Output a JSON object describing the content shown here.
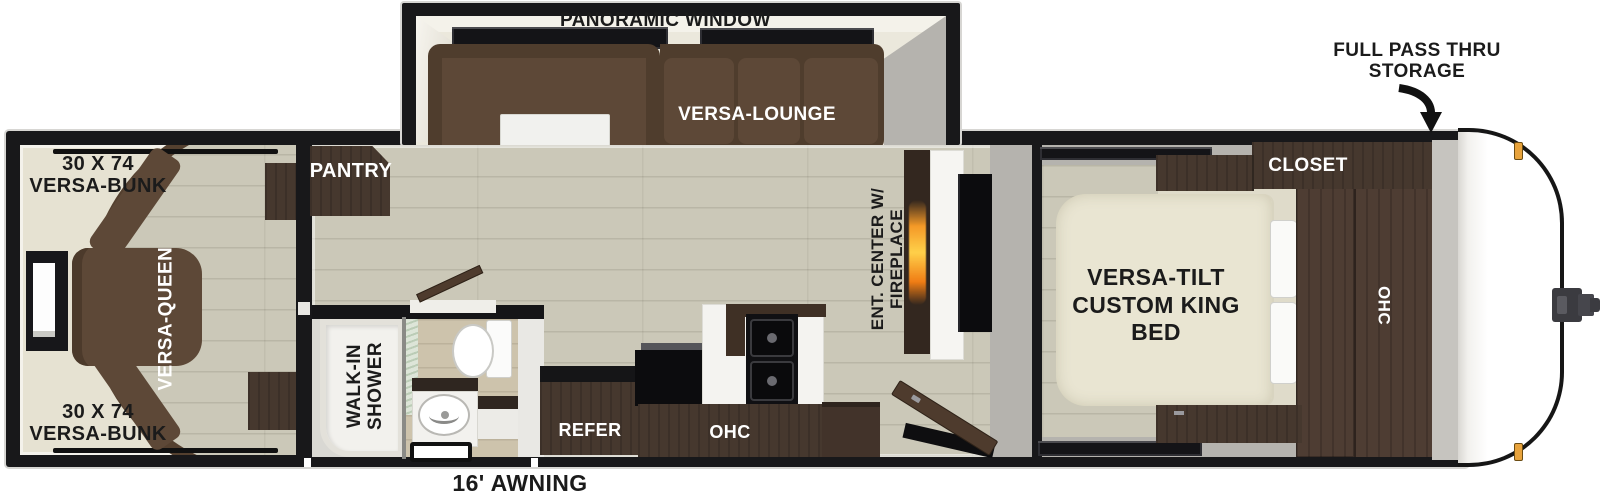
{
  "title": "Travel trailer floor plan",
  "labels": {
    "panoramic_window": "PANORAMIC WINDOW",
    "full_pass_thru_storage": "FULL PASS THRU STORAGE",
    "bunk_top": "30 X 74 VERSA-BUNK",
    "bunk_bottom": "30 X 74 VERSA-BUNK",
    "versa_queen": "VERSA-QUEEN",
    "pantry": "PANTRY",
    "versa_lounge": "VERSA-LOUNGE",
    "ent_center": "ENT. CENTER W/ FIREPLACE",
    "walk_in_shower": "WALK-IN SHOWER",
    "refer": "REFER",
    "kitchen_ohc": "OHC",
    "closet": "CLOSET",
    "king_bed": "VERSA-TILT CUSTOM KING BED",
    "bedroom_ohc": "OHC",
    "awning": "16' AWNING"
  },
  "colors": {
    "wall_black": "#18181a",
    "floor_wood": "#cbc8b8",
    "floor_cream": "#e6e2d2",
    "sofa_brown": "#5d4837",
    "cabinet_dark_wood": "#46382e",
    "interior_gray": "#b5b3ae",
    "slide_interior_ivory": "#ebe8dc",
    "flame_orange": "#f59a28",
    "marker_light_amber": "#e8a33c"
  }
}
